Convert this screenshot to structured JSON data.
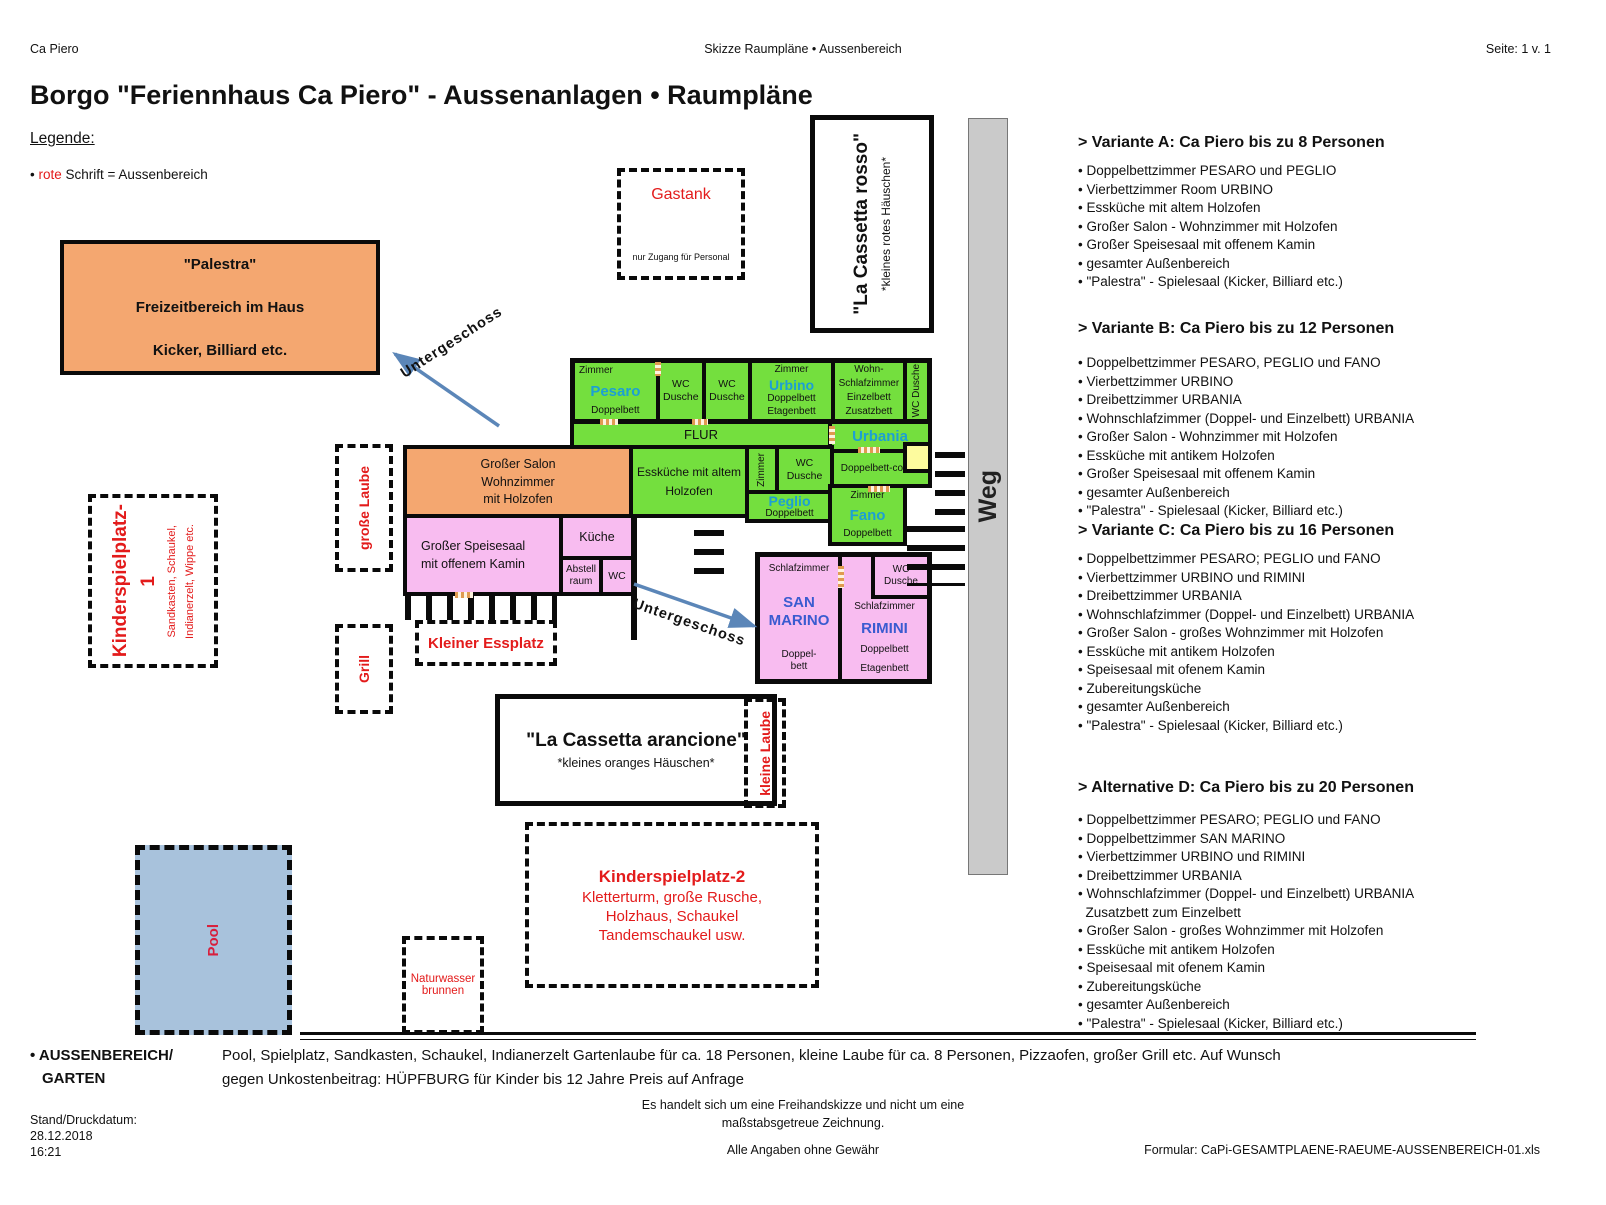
{
  "header": {
    "left": "Ca Piero",
    "center": "Skizze Raumpläne • Aussenbereich",
    "right": "Seite: 1 v. 1"
  },
  "title": "Borgo \"Feriennhaus Ca Piero\" - Aussenanlagen • Raumpläne",
  "legend": {
    "heading": "Legende:",
    "bullet": "•",
    "red_word": "rote",
    "rest": "Schrift = Aussenbereich"
  },
  "variants": [
    {
      "heading": "> Variante A: Ca Piero bis zu 8 Personen",
      "items": [
        "Doppelbettzimmer PESARO und PEGLIO",
        "Vierbettzimmer Room URBINO",
        "Essküche mit altem Holzofen",
        "Großer Salon - Wohnzimmer mit Holzofen",
        "Großer Speisesaal mit offenem Kamin",
        "gesamter Außenbereich",
        "\"Palestra\" - Spielesaal (Kicker, Billiard etc.)"
      ]
    },
    {
      "heading": "> Variante B: Ca Piero bis zu 12 Personen",
      "items": [
        "Doppelbettzimmer PESARO, PEGLIO und FANO",
        "Vierbettzimmer URBINO",
        "Dreibettzimmer URBANIA",
        "Wohnschlafzimmer (Doppel- und Einzelbett) URBANIA",
        "Großer Salon - Wohnzimmer mit Holzofen",
        "Essküche mit antikem Holzofen",
        "Großer Speisesaal mit offenem Kamin",
        "gesamter Außenbereich",
        "\"Palestra\" - Spielesaal (Kicker, Billiard etc.)"
      ]
    },
    {
      "heading": "> Variante C: Ca Piero bis zu 16 Personen",
      "items": [
        "Doppelbettzimmer PESARO; PEGLIO und FANO",
        "Vierbettzimmer URBINO und RIMINI",
        "Dreibettzimmer URBANIA",
        "Wohnschlafzimmer (Doppel- und Einzelbett) URBANIA",
        "Großer Salon - großes Wohnzimmer mit Holzofen",
        "Essküche mit antikem Holzofen",
        "Speisesaal mit ofenem Kamin",
        "Zubereitungsküche",
        "gesamter Außenbereich",
        "\"Palestra\" - Spielesaal (Kicker, Billiard etc.)"
      ]
    },
    {
      "heading": "> Alternative D: Ca Piero bis zu 20 Personen",
      "items": [
        "Doppelbettzimmer PESARO; PEGLIO und FANO",
        "Doppelbettzimmer SAN MARINO",
        "Vierbettzimmer URBINO und RIMINI",
        "Dreibettzimmer URBANIA",
        "Wohnschlafzimmer (Doppel- und Einzelbett) URBANIA",
        "Zusatzbett zum Einzelbett",
        "Großer Salon - großes Wohnzimmer mit Holzofen",
        "Essküche mit antikem Holzofen",
        "Speisesaal mit ofenem Kamin",
        "Zubereitungsküche",
        "gesamter Außenbereich",
        "\"Palestra\" - Spielesaal (Kicker, Billiard etc.)"
      ]
    }
  ],
  "plan": {
    "palestra": {
      "l1": "\"Palestra\"",
      "l2": "Freizeitbereich im Haus",
      "l3": "Kicker, Billiard etc."
    },
    "gastank": {
      "title": "Gastank",
      "note": "nur Zugang für Personal"
    },
    "cassetta_rosso": {
      "title": "\"La Cassetta rosso\"",
      "sub": "*kleines rotes Häuschen*"
    },
    "cassetta_arancione": {
      "title": "\"La Cassetta arancione\"",
      "sub": "*kleines oranges Häuschen*"
    },
    "weg": "Weg",
    "untergeschoss": "Untergeschoss",
    "flur": "FLUR",
    "pesaro": {
      "type": "Zimmer",
      "name": "Pesaro",
      "bed": "Doppelbett"
    },
    "wc_dusche": {
      "l1": "WC",
      "l2": "Dusche"
    },
    "urbino": {
      "type": "Zimmer",
      "name": "Urbino",
      "bed1": "Doppelbett",
      "bed2": "Etagenbett"
    },
    "wohnschlaf": {
      "l1": "Wohn-",
      "l2": "Schlafzimmer",
      "l3": "Einzelbett",
      "l4": "Zusatzbett"
    },
    "urbania": {
      "name": "Urbania",
      "bed": "Doppelbett-couch"
    },
    "salon": {
      "l1": "Großer Salon",
      "l2": "Wohnzimmer",
      "l3": "mit Holzofen"
    },
    "esskueche": {
      "l1": "Essküche mit altem",
      "l2": "Holzofen"
    },
    "zimmer_vert": "Zimmer",
    "peglio": {
      "name": "Peglio",
      "bed": "Doppelbett"
    },
    "fano": {
      "type": "Zimmer",
      "name": "Fano",
      "bed": "Doppelbett"
    },
    "speisesaal": {
      "l1": "Großer Speisesaal",
      "l2": "mit offenem Kamin"
    },
    "kueche": "Küche",
    "abstell": {
      "l1": "Abstell",
      "l2": "raum"
    },
    "wc": "WC",
    "sanmarino": {
      "type": "Schlafzimmer",
      "n1": "SAN",
      "n2": "MARINO",
      "b1": "Doppel-",
      "b2": "bett"
    },
    "rimini": {
      "type": "Schlafzimmer",
      "name": "RIMINI",
      "bed1": "Doppelbett",
      "bed2": "Etagenbett"
    },
    "grosse_laube": "große Laube",
    "grill": "Grill",
    "kleine_laube": "kleine Laube",
    "kleiner_essplatz": "Kleiner Essplatz",
    "spielplatz1": {
      "main1": "Kinderspielplatz-",
      "main2": "1",
      "sub1": "Sandkasten, Schaukel,",
      "sub2": "Indianerzelt, Wippe etc."
    },
    "spielplatz2": {
      "title": "Kinderspielplatz-2",
      "l1": "Kletterturm, große Rusche,",
      "l2": "Holzhaus, Schaukel",
      "l3": "Tandemschaukel usw."
    },
    "naturwasser": {
      "l1": "Naturwasser",
      "l2": "brunnen"
    },
    "pool": "Pool"
  },
  "footer": {
    "aussen_label1": "• AUSSENBEREICH/",
    "aussen_label2": "GARTEN",
    "body1": "Pool, Spielplatz, Sandkasten, Schaukel, Indianerzelt  Gartenlaube für ca. 18 Personen, kleine Laube für  ca. 8 Personen, Pizzaofen, großer Grill etc. Auf Wunsch",
    "body2": "gegen Unkostenbeitrag:  HÜPFBURG für Kinder bis 12 Jahre Preis auf Anfrage",
    "disclaimer1": "Es handelt  sich um eine Freihandskizze und nicht um eine",
    "disclaimer2": "maßstabsgetreue Zeichnung.",
    "stand_label": "Stand/Druckdatum:",
    "date": "28.12.2018",
    "time": "16:21",
    "no_guarantee": "Alle Angaben ohne Gewähr",
    "formular": "Formular: CaPi-GESAMTPLAENE-RAEUME-AUSSENBEREICH-01.xls"
  },
  "colors": {
    "room_green": "#74df3e",
    "room_pink": "#f8bcf0",
    "room_orange": "#f4a770",
    "highlight_yellow": "#fdfb9e",
    "pool_blue": "#a8c2dc",
    "weg_gray": "#cacaca",
    "outdoor_red": "#e31b1b",
    "room_name_blue": "#1c9fd4",
    "marino_blue": "#3a5bd0",
    "arrow_blue": "#5b86b8"
  }
}
